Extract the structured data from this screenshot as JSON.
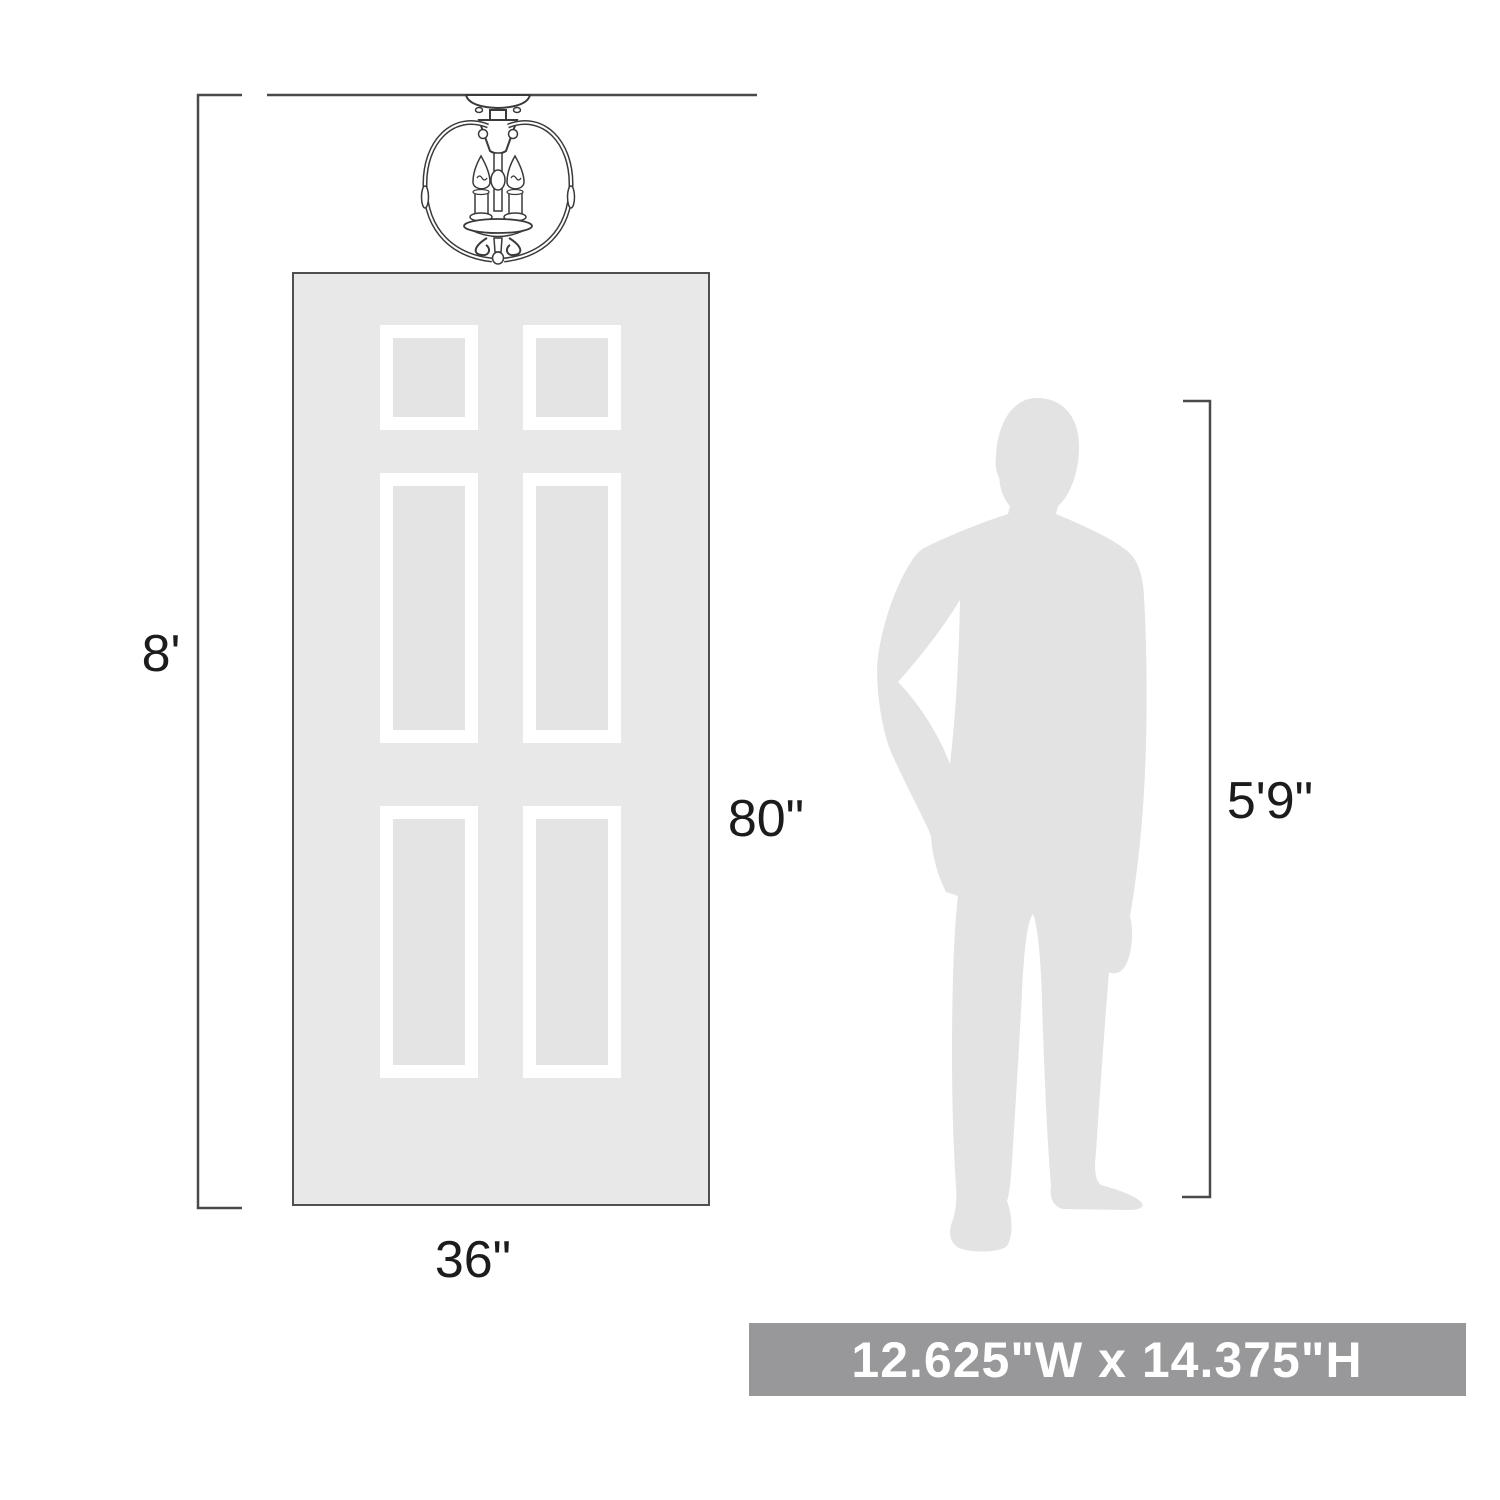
{
  "labels": {
    "ceiling_height": "8'",
    "door_height": "80\"",
    "door_width": "36\"",
    "person_height": "5'9\""
  },
  "banner": {
    "text": "12.625\"W x 14.375\"H"
  },
  "graphics": {
    "fixture": "3-light semi-flush chandelier line drawing",
    "door": "6-panel door outline",
    "person": "standing man silhouette"
  },
  "colors": {
    "line": "#4a4a4a",
    "fixture_line": "#3a3a3a",
    "door_fill": "#e8e8e8",
    "door_border": "#4f4f4f",
    "panel_inner": "#e4e4e4",
    "panel_frame": "#ffffff",
    "silhouette": "#e3e3e3",
    "banner_bg": "#98989b",
    "banner_text": "#ffffff",
    "label_text": "#1c1c1c"
  }
}
